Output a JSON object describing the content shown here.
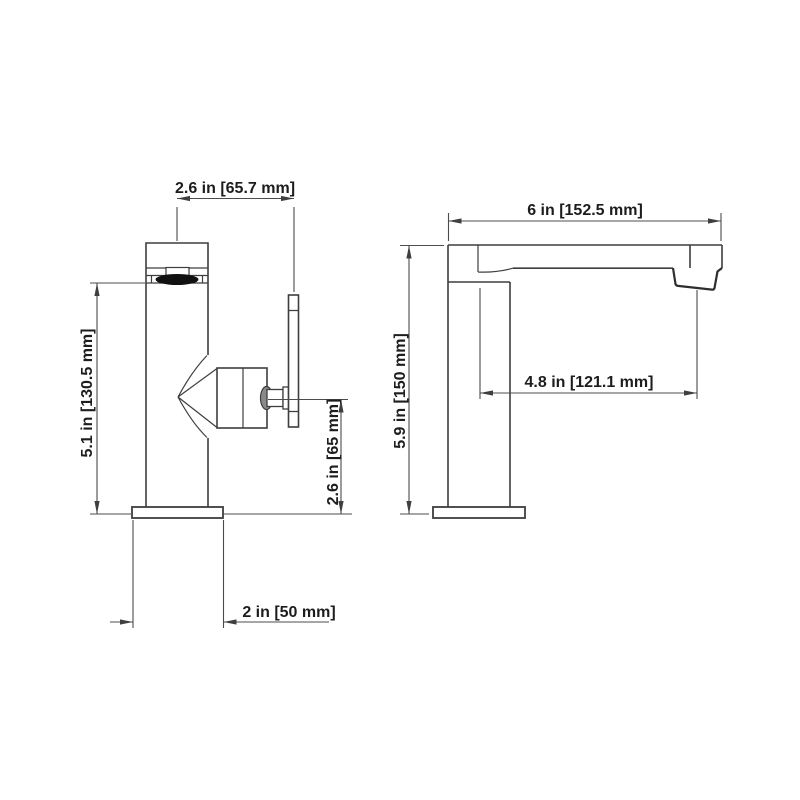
{
  "meta": {
    "drawing_type": "faucet installation dimension drawing",
    "background_color": "#ffffff",
    "line_color": "#3e3e3e",
    "dimension_line_color": "#4c4c4c",
    "text_color": "#1d1d1d",
    "aerator_fill": "#111111"
  },
  "views": {
    "front": {
      "name": "faucet front view (body, aerator, side handle)"
    },
    "side": {
      "name": "faucet side view (column and spout)"
    }
  },
  "dimensions": {
    "handle_reach": {
      "label": "2.6 in [65.7 mm]",
      "inches": "2.6",
      "mm": "65.7"
    },
    "aerator_height": {
      "label": "5.1 in [130.5 mm]",
      "inches": "5.1",
      "mm": "130.5"
    },
    "handle_height": {
      "label": "2.6 in [65 mm]",
      "inches": "2.6",
      "mm": "65"
    },
    "base_width": {
      "label": "2 in [50 mm]",
      "inches": "2",
      "mm": "50"
    },
    "overall_length": {
      "label": "6 in [152.5 mm]",
      "inches": "6",
      "mm": "152.5"
    },
    "overall_height": {
      "label": "5.9 in [150 mm]",
      "inches": "5.9",
      "mm": "150"
    },
    "spout_reach": {
      "label": "4.8 in [121.1 mm]",
      "inches": "4.8",
      "mm": "121.1"
    }
  }
}
